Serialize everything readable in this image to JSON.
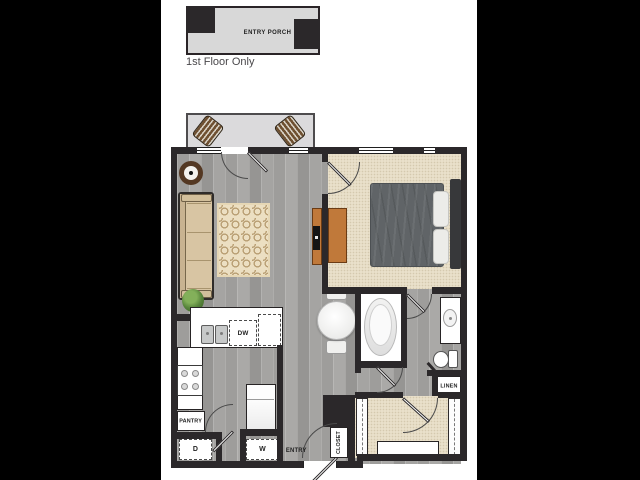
{
  "header": {
    "porch_label": "ENTRY PORCH",
    "floor_note": "1st Floor Only"
  },
  "labels": {
    "dishwasher": "DW",
    "pantry": "PANTRY",
    "dryer": "D",
    "washer": "W",
    "entry": "ENTRY",
    "closet": "CLOSET",
    "linen": "LINEN"
  },
  "colors": {
    "letterbox": "#000000",
    "canvas": "#ffffff",
    "wall": "#2b282a",
    "wood": "#a3a2a0",
    "carpet": "#e9e0ca",
    "balcony": "#dbdadc",
    "porch": "#d8d8d8",
    "accent_wood": "#c0793a",
    "sofa": "#d8c5a3",
    "duvet": "#606467",
    "plant": "#58853c",
    "rug": "#ecdfc2"
  }
}
